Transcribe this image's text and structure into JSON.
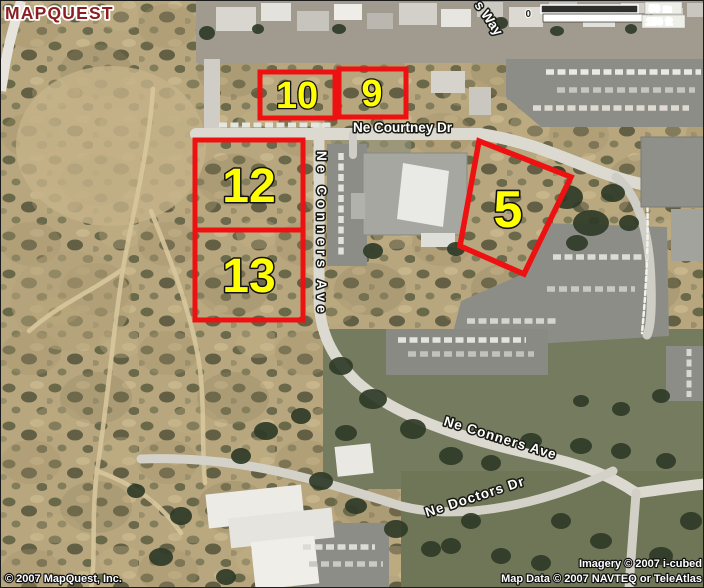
{
  "logo": {
    "text": "MAPQUEST"
  },
  "scale_bar": {
    "zero": "0",
    "metric": "50 m",
    "imperial": "150 ft"
  },
  "parcels": {
    "p10": "10",
    "p9": "9",
    "p12": "12",
    "p13": "13",
    "p5": "5"
  },
  "streets": {
    "courtney": "Ne Courtney Dr",
    "conners_vertical": "Ne Conners Ave",
    "conners_diagonal": "Ne Conners Ave",
    "doctors": "Ne Doctors Dr",
    "partial_way": "s Way"
  },
  "credits": {
    "mapquest": "© 2007 MapQuest, Inc.",
    "imagery": "Imagery © 2007 i-cubed",
    "map_data": "Map Data © 2007 NAVTEQ or TeleAtlas"
  },
  "colors": {
    "parcel_outline": "#ee1111",
    "parcel_label": "#ffff00",
    "logo_red": "#8b1e22",
    "street_label": "#ffffff"
  }
}
